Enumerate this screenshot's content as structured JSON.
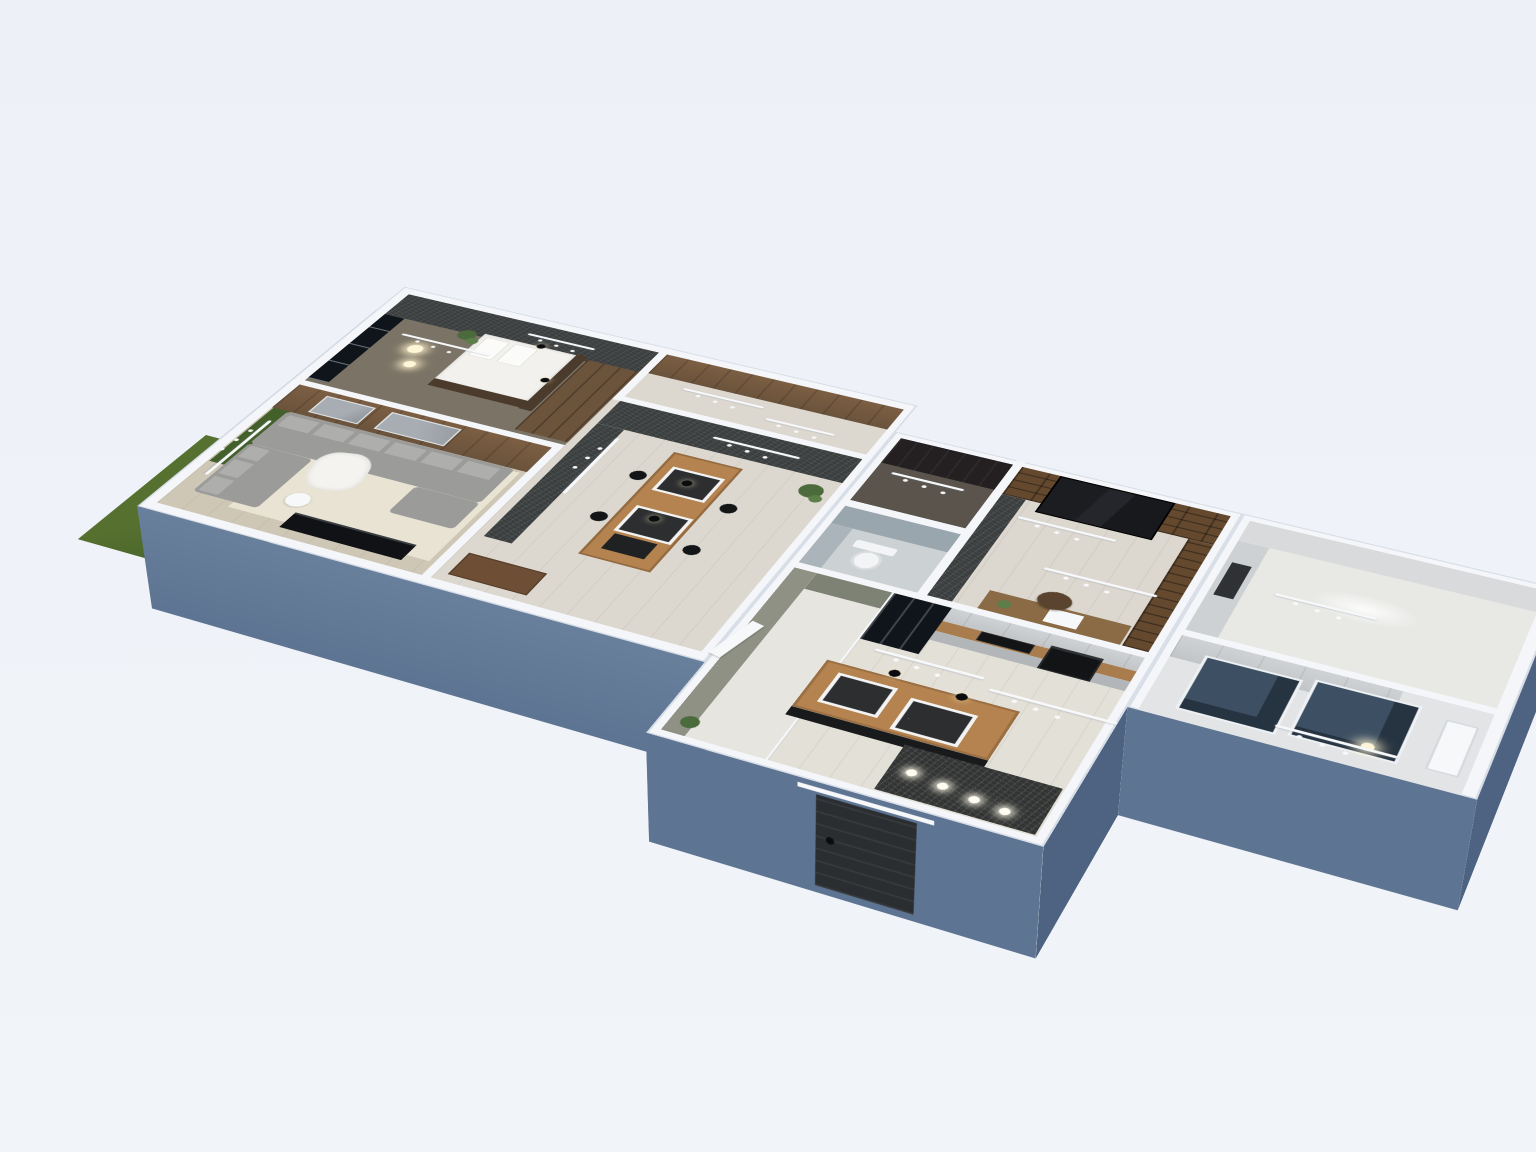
{
  "scene": {
    "type": "3d-floorplan-render",
    "view": "dollhouse-isometric",
    "floors_shown": 1
  },
  "colors": {
    "background": "#edf1f7",
    "cap": "#f4f6fa",
    "cap-edge": "#d7dde6",
    "ext-wall": "#5d7492",
    "ext-wall-light": "#69809d",
    "ext-wall-dark": "#4e6381",
    "grass": "#55702f",
    "grass-dark": "#44602a",
    "floor-bedroom": "#7b7365",
    "floor-pale": "#dcd8d0",
    "floor-wood": "#cfc7b5",
    "floor-light": "#e3e0d8",
    "floor-entry": "#5a544d",
    "floor-wc": "#ccd1d4",
    "floor-bath": "#e2e4e6",
    "floor-utility": "#e8e8e5",
    "rug": "#e9e3d3",
    "granite": "#3b3e3e",
    "granite-floor": "#323433",
    "wood-wall": "#6b533c",
    "wood-mid": "#7c5f43",
    "wood-dark": "#4a3b2c",
    "shelf-wood": "#64492f",
    "bookcase-dark": "#191b1e",
    "cabinet-gray": "#c2c5c7",
    "cabinet-gray-dark": "#b3b6b9",
    "cabinet-light": "#ced1d3",
    "counter-wood": "#a87c4d",
    "island-wood": "#b5834f",
    "island-base": "#191a1c",
    "appliance-black": "#121416",
    "glass-dark": "#10151b",
    "glass-blue": "#3d5063",
    "olive": "#8e9184",
    "olive-dark": "#7e8274",
    "wc-gray": "#9aa6ad",
    "toilet-white": "#f2f4f5",
    "sofa": "#9b9b99",
    "sofa-light": "#aeaeac",
    "white-soft": "#f7f8f9",
    "door-dark": "#2b2e31",
    "tray-dark": "#2c2e30",
    "desk-wood": "#8b6a46",
    "sideboard": "#6e4f35",
    "tv-black": "#111216",
    "plant": "#4c6b3c",
    "plant-light": "#5d7d49",
    "art-gray": "#a7adb2"
  },
  "rooms": [
    {
      "name": "bedroom",
      "contents": [
        "bed",
        "wardrobe",
        "floor-lamp",
        "plant",
        "pendant-lights",
        "track-light",
        "accent-wallpaper-wall",
        "window"
      ]
    },
    {
      "name": "living-room",
      "contents": [
        "corner-sofa",
        "cushions",
        "blanket",
        "rug",
        "tv-stand",
        "side-table",
        "wood-panel-wall",
        "wall-art",
        "garden-window"
      ]
    },
    {
      "name": "dining-area",
      "contents": [
        "bar-table",
        "bar-stools",
        "serving-trays",
        "pendant-lights",
        "plant",
        "sideboard",
        "granite-accent-wall"
      ]
    },
    {
      "name": "hallway",
      "contents": [
        "wood-panel-wall",
        "track-light"
      ]
    },
    {
      "name": "entry-closet",
      "contents": [
        "dark-wardrobe"
      ]
    },
    {
      "name": "wc",
      "contents": [
        "toilet"
      ]
    },
    {
      "name": "office",
      "contents": [
        "bookshelf-wall",
        "dark-bookcase",
        "desk",
        "desk-chair",
        "plant",
        "track-lights"
      ]
    },
    {
      "name": "kitchen",
      "contents": [
        "upper-cabinets",
        "counter",
        "cooktop",
        "oven",
        "glass-front-cabinet",
        "island",
        "serving-trays",
        "pendant-lights"
      ]
    },
    {
      "name": "entry-hall",
      "contents": [
        "olive-walls",
        "white-door",
        "plant"
      ]
    },
    {
      "name": "vestibule",
      "contents": [
        "granite-floor",
        "ceiling-spotlights",
        "front-door"
      ]
    },
    {
      "name": "utility-room",
      "contents": [
        "cabinet-run",
        "appliance-slot",
        "ceiling-light"
      ]
    },
    {
      "name": "bathroom",
      "contents": [
        "glass-shower-panels",
        "door",
        "cabinet-run",
        "light"
      ]
    },
    {
      "name": "garden",
      "contents": [
        "grass-patch"
      ]
    }
  ]
}
